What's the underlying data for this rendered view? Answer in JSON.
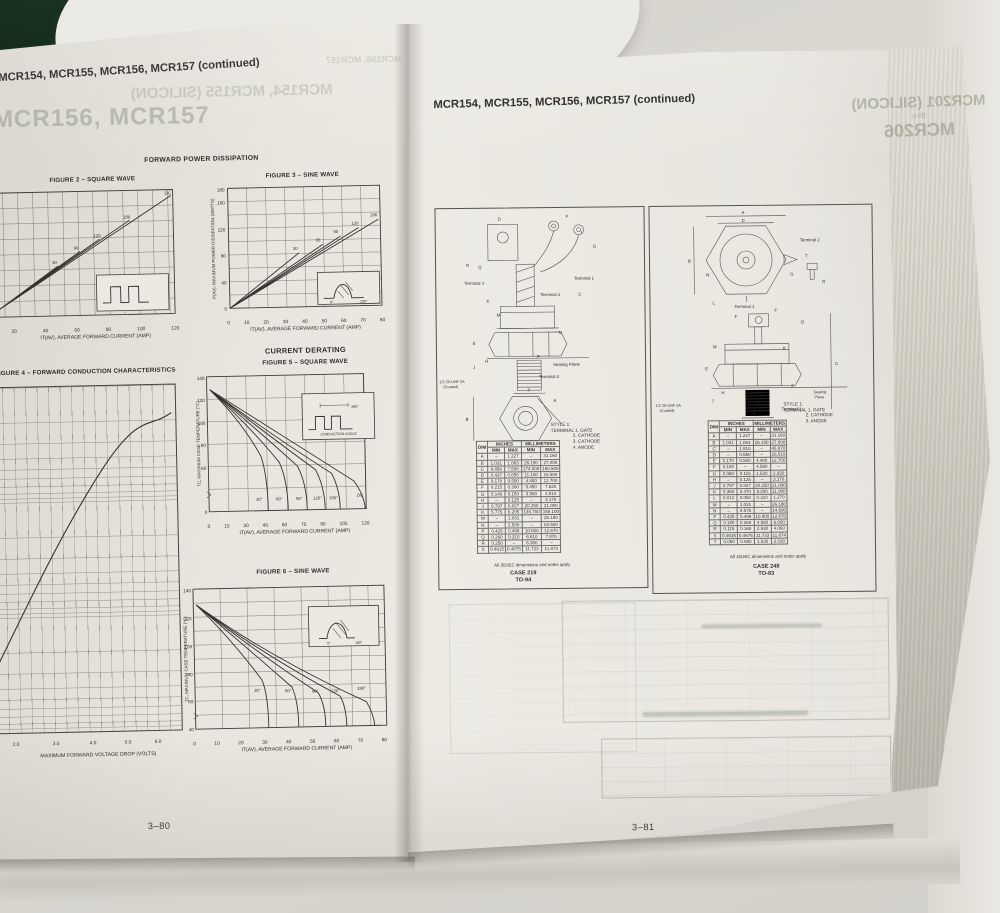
{
  "left_page": {
    "header": "MCR154, MCR155, MCR156, MCR157 (continued)",
    "ghost_top": "MCR156, MCR157",
    "ghost_line1": "MCR154, MCR155 (SILICON)",
    "ghost_line2": "MCR156, MCR157",
    "section_title": "FORWARD POWER DISSIPATION",
    "derating_title": "CURRENT DERATING",
    "page_number": "3–80",
    "fig2": {
      "title": "FIGURE 2 – SQUARE WAVE",
      "x_label": "IT(AV), AVERAGE FORWARD CURRENT (AMP)",
      "x_ticks": [
        "20",
        "40",
        "60",
        "80",
        "100",
        "120"
      ],
      "y_tick_fragments": [
        "40",
        "20",
        "0"
      ],
      "curves": [
        "DC",
        "180",
        "120",
        "90",
        "30"
      ]
    },
    "fig3": {
      "title": "FIGURE 3 – SINE WAVE",
      "y_label": "P(AV), MAXIMUM POWER DISSIPATION (WATTS)",
      "y_ticks": [
        "180",
        "160",
        "120",
        "80",
        "40",
        "0"
      ],
      "x_ticks": [
        "0",
        "10",
        "20",
        "30",
        "40",
        "50",
        "60",
        "70",
        "80"
      ],
      "x_label": "IT(AV), AVERAGE FORWARD CURRENT (AMP)",
      "curves": [
        "180",
        "120",
        "90",
        "60",
        "30"
      ],
      "inset": [
        "0°",
        "180°"
      ]
    },
    "fig4": {
      "title": "FIGURE 4 – FORWARD CONDUCTION CHARACTERISTICS",
      "x_ticks": [
        "2.0",
        "3.0",
        "4.0",
        "5.0",
        "6.0"
      ],
      "x_label": "MAXIMUM FORWARD VOLTAGE DROP (VOLTS)"
    },
    "fig5": {
      "title": "FIGURE 5 – SQUARE WAVE",
      "y_label": "TC, MAXIMUM CASE TEMPERATURE (°C)",
      "y_ticks": [
        "140",
        "120",
        "100",
        "80",
        "60",
        "0"
      ],
      "x_ticks": [
        "0",
        "15",
        "30",
        "45",
        "60",
        "75",
        "90",
        "105",
        "120"
      ],
      "x_label": "IT(AV), AVERAGE FORWARD CURRENT (AMP)",
      "curves": [
        "30°",
        "60°",
        "90°",
        "120°",
        "180°",
        "DC"
      ],
      "inset_top": "360°",
      "inset_bottom": "CONDUCTION ANGLE"
    },
    "fig6": {
      "title": "FIGURE 6 – SINE WAVE",
      "y_ticks": [
        "140",
        "120",
        "100",
        "80",
        "60",
        "40"
      ],
      "x_ticks": [
        "0",
        "10",
        "20",
        "30",
        "40",
        "50",
        "60",
        "70",
        "80"
      ],
      "x_label": "IT(AV), AVERAGE FORWARD CURRENT (AMP)",
      "curves": [
        "30°",
        "60°",
        "90°",
        "120°",
        "180°"
      ],
      "inset": [
        "0°",
        "180°"
      ]
    }
  },
  "right_page": {
    "header": "MCR154, MCR155, MCR156, MCR157 (continued)",
    "ghost": {
      "line1": "MCR201 (SILICON)",
      "line2": "thru",
      "line3": "MCR206"
    },
    "page_number": "3–81",
    "case219": {
      "labels": {
        "terminal1": "Terminal 1",
        "terminal2": "Terminal 2",
        "terminal3": "Terminal 3",
        "terminal4": "Terminal 4",
        "seating": "Seating Plane",
        "thread1": "1/2 20-UNF 2A",
        "thread2": "(Coated)"
      },
      "dims": [
        "D",
        "F",
        "I",
        "G",
        "R",
        "Q",
        "K",
        "M",
        "N",
        "C",
        "E",
        "H",
        "J",
        "P",
        "S",
        "A",
        "B"
      ],
      "style_title": "STYLE 1:",
      "style_lines": [
        "TERMINAL 1. GATE",
        "2. CATHODE",
        "3. CATHODE",
        "4. ANODE"
      ],
      "table_headers": {
        "dim": "DIM",
        "inches": "INCHES",
        "mm": "MILLIMETERS",
        "min": "MIN",
        "max": "MAX"
      },
      "rows": [
        [
          "A",
          "–",
          "1.227",
          "–",
          "31.160"
        ],
        [
          "B",
          "1.031",
          "1.063",
          "26.190",
          "27.000"
        ],
        [
          "C",
          "6.850",
          "7.500",
          "174.000",
          "190.500"
        ],
        [
          "D",
          "0.437",
          "0.650",
          "11.100",
          "16.500"
        ],
        [
          "E",
          "0.170",
          "0.500",
          "4.400",
          "12.700"
        ],
        [
          "F",
          "0.215",
          "0.300",
          "5.490",
          "7.620"
        ],
        [
          "G",
          "0.140",
          "0.150",
          "3.560",
          "3.810"
        ],
        [
          "H",
          "–",
          "0.125",
          "–",
          "3.170"
        ],
        [
          "J",
          "0.797",
          "0.827",
          "20.250",
          "21.000"
        ],
        [
          "K",
          "5.775",
          "6.205",
          "146.700",
          "158.100"
        ],
        [
          "M",
          "–",
          "1.031",
          "–",
          "26.180"
        ],
        [
          "N",
          "–",
          "2.500",
          "–",
          "63.500"
        ],
        [
          "P",
          "0.425",
          "0.499",
          "10.800",
          "12.670"
        ],
        [
          "Q",
          "0.260",
          "0.310",
          "6.610",
          "7.870"
        ],
        [
          "R",
          "0.250",
          "–",
          "6.350",
          "–"
        ],
        [
          "S",
          "0.4615",
          "0.4675",
          "11.723",
          "11.874"
        ]
      ],
      "note": "All JEDEC dimensions and notes apply",
      "case": "CASE 219",
      "to": "TO-94"
    },
    "case248": {
      "labels": {
        "terminal1": "Terminal 1",
        "terminal2": "Terminal 2",
        "terminal3": "Terminal 3",
        "seating1": "Seating",
        "seating2": "Plane",
        "thread1": "1/2 20-UNF 2A",
        "thread2": "(Coated)"
      },
      "dims": [
        "A",
        "D",
        "B",
        "N",
        "L",
        "G",
        "T",
        "R",
        "F",
        "F",
        "Q",
        "M",
        "K",
        "C",
        "E",
        "J",
        "H",
        "P",
        "S"
      ],
      "style_title": "STYLE 1:",
      "style_lines": [
        "TERMINAL 1. GATE",
        "2. CATHODE",
        "3. ANODE"
      ],
      "table_headers": {
        "dim": "DIM",
        "inches": "INCHES",
        "mm": "MILLIMETERS",
        "min": "MIN",
        "max": "MAX"
      },
      "rows": [
        [
          "A",
          "–",
          "1.227",
          "–",
          "31.160"
        ],
        [
          "B",
          "1.031",
          "1.063",
          "26.190",
          "27.000"
        ],
        [
          "C",
          "–",
          "1.810",
          "–",
          "45.970"
        ],
        [
          "D",
          "–",
          "0.650",
          "–",
          "16.510"
        ],
        [
          "E",
          "0.170",
          "0.500",
          "4.400",
          "12.700"
        ],
        [
          "F",
          "0.180",
          "–",
          "4.580",
          "–"
        ],
        [
          "G",
          "0.060",
          "0.115",
          "1.530",
          "2.920"
        ],
        [
          "H",
          "–",
          "0.125",
          "–",
          "3.170"
        ],
        [
          "J",
          "0.797",
          "0.827",
          "20.250",
          "21.000"
        ],
        [
          "K",
          "0.360",
          "0.470",
          "9.200",
          "11.900"
        ],
        [
          "L",
          "0.012",
          "0.050",
          "0.310",
          "1.270"
        ],
        [
          "M",
          "–",
          "1.031",
          "–",
          "26.180"
        ],
        [
          "N",
          "–",
          "0.575",
          "–",
          "14.600"
        ],
        [
          "P",
          "0.425",
          "0.499",
          "10.800",
          "12.670"
        ],
        [
          "Q",
          "0.180",
          "0.260",
          "4.580",
          "6.600"
        ],
        [
          "R",
          "0.115",
          "0.160",
          "2.930",
          "4.060"
        ],
        [
          "S",
          "0.4615",
          "0.4675",
          "11.733",
          "11.874"
        ],
        [
          "T",
          "0.060",
          "0.080",
          "1.530",
          "2.030"
        ]
      ],
      "note": "All JEDEC dimensions and notes apply",
      "case": "CASE 248",
      "to": "TO-83"
    }
  }
}
